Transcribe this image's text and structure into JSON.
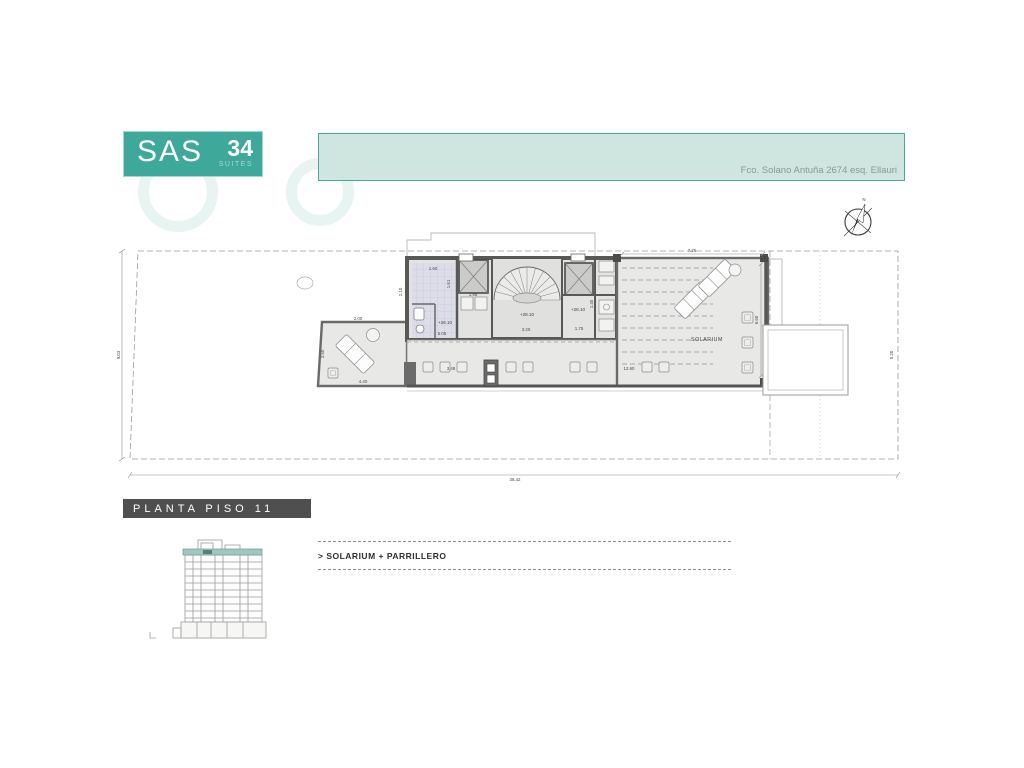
{
  "header": {
    "logo": {
      "brand": "SAS",
      "number": "34",
      "suffix": "SUITES"
    },
    "address": "Fco. Solano Antuña 2674 esq. Ellauri"
  },
  "compass": {
    "north": "N"
  },
  "plan": {
    "rooms": {
      "solarium": "SOLARIUM",
      "parrillero": "PARRILLERO"
    },
    "levels": {
      "bath": "+28.10",
      "stair": "+28.10",
      "room": "+28.10"
    },
    "dims": {
      "site_left": "9.03",
      "site_bottom": "38.42",
      "site_right": "9.20",
      "terrace_top": "2.00",
      "terrace_left": "3.50",
      "terrace_bottom": "4.40",
      "core_left": "2.10",
      "bath_top": "1.60",
      "bath_side": "1.61",
      "bath_closet": "1.98",
      "bath_bottom": "5.05",
      "stair_bottom": "3.20",
      "room_bottom": "1.75",
      "strip_side": "1.40",
      "solarium_top": "7.25",
      "solarium_right": "6.60",
      "deck_bottom_left": "3.48",
      "deck_bottom_right": "12.60"
    }
  },
  "footer": {
    "plan_title": "PLANTA PISO 11",
    "legend": "> SOLARIUM + PARRILLERO"
  }
}
